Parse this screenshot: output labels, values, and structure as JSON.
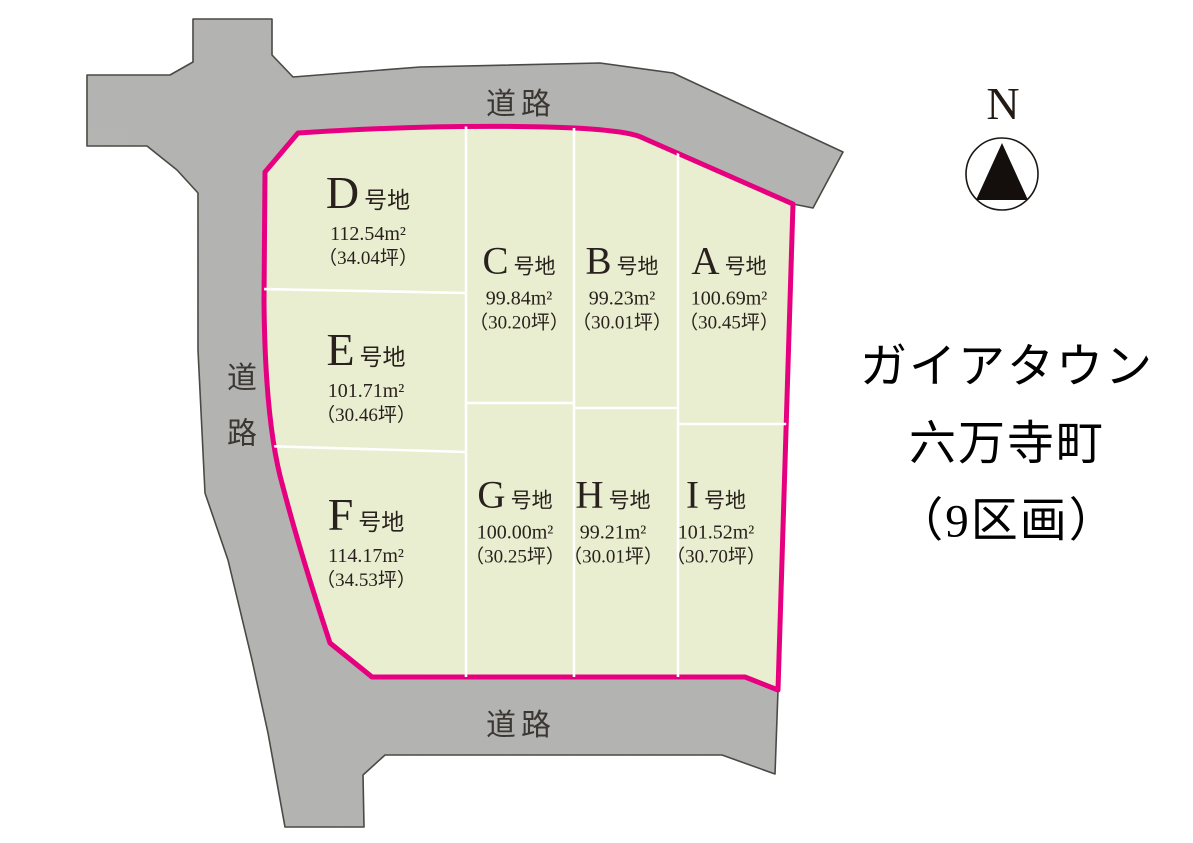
{
  "title": {
    "line1": "ガイアタウン",
    "line2": "六万寺町",
    "line3": "（9区画）"
  },
  "compass": {
    "label": "N"
  },
  "roads": {
    "top": "道路",
    "left": "道路",
    "bottom": "道路"
  },
  "plots": [
    {
      "id": "A",
      "suffix": "号地",
      "area": "100.69m²",
      "tsubo": "（30.45坪）"
    },
    {
      "id": "B",
      "suffix": "号地",
      "area": "99.23m²",
      "tsubo": "（30.01坪）"
    },
    {
      "id": "C",
      "suffix": "号地",
      "area": "99.84m²",
      "tsubo": "（30.20坪）"
    },
    {
      "id": "D",
      "suffix": "号地",
      "area": "112.54m²",
      "tsubo": "（34.04坪）"
    },
    {
      "id": "E",
      "suffix": "号地",
      "area": "101.71m²",
      "tsubo": "（30.46坪）"
    },
    {
      "id": "F",
      "suffix": "号地",
      "area": "114.17m²",
      "tsubo": "（34.53坪）"
    },
    {
      "id": "G",
      "suffix": "号地",
      "area": "100.00m²",
      "tsubo": "（30.25坪）"
    },
    {
      "id": "H",
      "suffix": "号地",
      "area": "99.21m²",
      "tsubo": "（30.01坪）"
    },
    {
      "id": "I",
      "suffix": "号地",
      "area": "101.52m²",
      "tsubo": "（30.70坪）"
    }
  ],
  "colors": {
    "road_gray": "#b4b4b2",
    "road_outline": "#4a4742",
    "plot_green": "#e8eecf",
    "boundary_pink": "#e60080",
    "divider_white": "#ffffff",
    "text_dark": "#28211d"
  }
}
